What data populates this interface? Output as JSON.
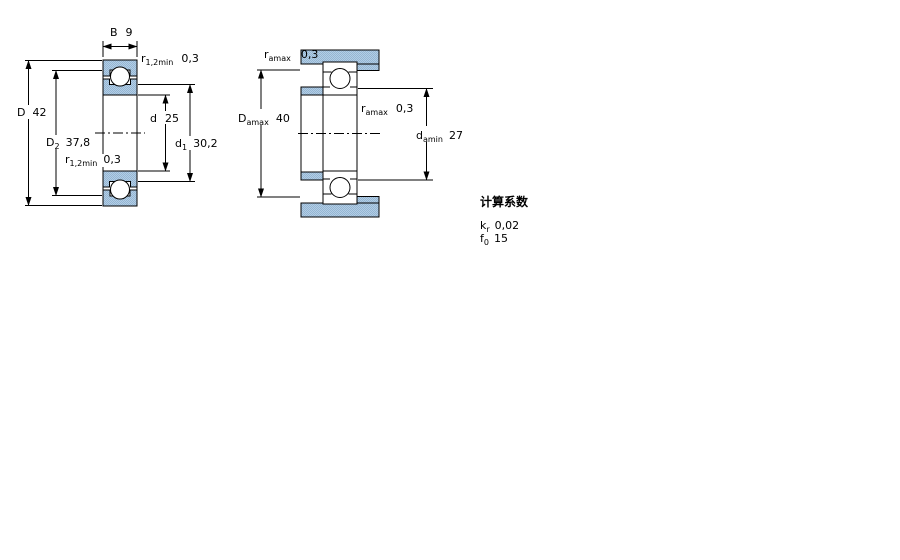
{
  "figure1": {
    "name": "bearing-cross-section",
    "dims": {
      "B": {
        "label": "B",
        "sub": "",
        "value": "9"
      },
      "r_top": {
        "label": "r",
        "sub": "1,2min",
        "value": "0,3"
      },
      "D": {
        "label": "D",
        "sub": "",
        "value": "42"
      },
      "D2": {
        "label": "D",
        "sub": "2",
        "value": "37,8"
      },
      "d": {
        "label": "d",
        "sub": "",
        "value": "25"
      },
      "d1": {
        "label": "d",
        "sub": "1",
        "value": "30,2"
      },
      "r_bottom": {
        "label": "r",
        "sub": "1,2min",
        "value": "0,3"
      }
    }
  },
  "figure2": {
    "name": "abutment-and-fillet-dimensions",
    "dims": {
      "ra_top": {
        "label": "r",
        "sub": "amax",
        "value": "0,3"
      },
      "Da": {
        "label": "D",
        "sub": "amax",
        "value": "40"
      },
      "ra_mid": {
        "label": "r",
        "sub": "amax",
        "value": "0,3"
      },
      "da": {
        "label": "d",
        "sub": "amin",
        "value": "27"
      }
    }
  },
  "calculation_factors": {
    "title": "计算系数",
    "rows": [
      {
        "label": "k",
        "sub": "r",
        "value": "0,02"
      },
      {
        "label": "f",
        "sub": "0",
        "value": "15"
      }
    ]
  },
  "colors": {
    "section_fill_light": "#b3cde5",
    "section_fill_dark": "#94b6d3",
    "line": "#000000",
    "background": "#ffffff"
  }
}
